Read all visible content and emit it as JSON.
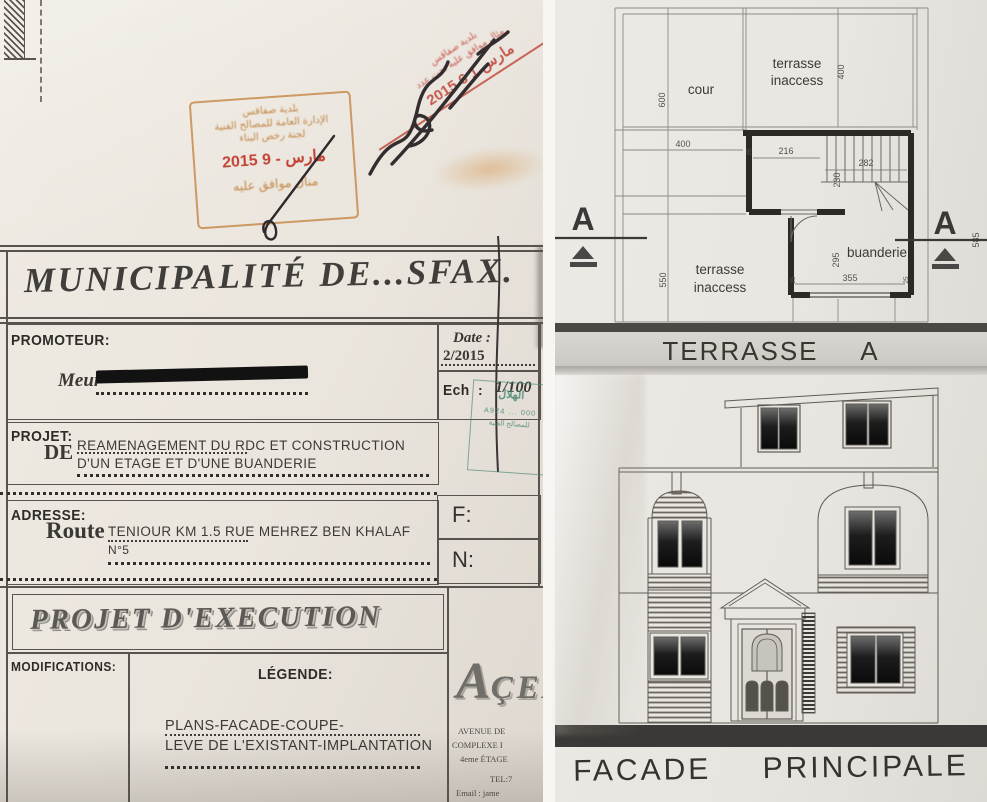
{
  "left_document": {
    "title": "MUNICIPALITÉ DE...SFAX.",
    "promoteur": {
      "label": "PROMOTEUR:",
      "meur": "Meur"
    },
    "date": {
      "label": "Date :",
      "value": "2/2015"
    },
    "ech": {
      "label": "Ech",
      "colon": ":",
      "value": "1/100"
    },
    "projet": {
      "label": "PROJET:",
      "de": "DE",
      "line1": "REAMENAGEMENT DU RDC ET CONSTRUCTION",
      "line2": "D'UN ETAGE ET D'UNE BUANDERIE"
    },
    "adresse": {
      "label": "ADRESSE:",
      "route": "Route",
      "line1": "TENIOUR KM 1.5 RUE MEHREZ BEN KHALAF",
      "line2": "N°5"
    },
    "f_label": "F:",
    "n_label": "N:",
    "banner": "PROJET D'EXECUTION",
    "modifications_label": "MODIFICATIONS:",
    "legende": {
      "label": "LÉGENDE:",
      "line1": "PLANS-FACADE-COUPE-",
      "line2": "LEVE DE L'EXISTANT-IMPLANTATION"
    },
    "firm": {
      "logo_initial": "A",
      "logo_rest": "ÇEA",
      "addr1": "AVENUE DE",
      "addr2": "COMPLEXE I",
      "addr3": "4eme ÉTAGE",
      "tel": "TEL:7",
      "email": "Email : jame"
    },
    "stamps": {
      "rect": {
        "line1": "بلدية صفاقس",
        "line2": "الإدارة العامة للمصالح الفنية",
        "line3": "لجنة رخص البناء",
        "date": "2015  مارس  - 9",
        "footer": "منال موافق عليه"
      },
      "diagonal": {
        "line1": "بلدية صفاقس",
        "line2": "مثال موافق عليه تحت عدد",
        "date": "2015  مارس  1 6"
      },
      "green": {
        "line1": "الهلال",
        "line2": "A924 ... 000",
        "line3": "للمصالح الفنية"
      }
    }
  },
  "plan": {
    "title": "TERRASSE A CONSTRUIRE",
    "labels": {
      "cour": "cour",
      "terrasse_l1": "terrasse",
      "terrasse_l2": "inaccess",
      "buanderie": "buanderie",
      "section": "A"
    },
    "dims": {
      "d600": "600",
      "d400v": "400",
      "d400h": "400",
      "d216": "216",
      "d282": "282",
      "d230": "230",
      "d295": "295",
      "d355": "355",
      "d550": "550",
      "d585": "585",
      "d25": "25"
    }
  },
  "facade": {
    "title": "FACADE PRINCIPALE"
  },
  "colors": {
    "stamp_orange": "#bd7c38",
    "stamp_red": "#c23a2e",
    "stamp_green": "#4a8573",
    "ink": "#332d2f",
    "paper_left": "#eae5dd",
    "paper_right": "#eae7e2",
    "line_dark": "#2c2a27",
    "line_thin": "#8d8a84"
  }
}
